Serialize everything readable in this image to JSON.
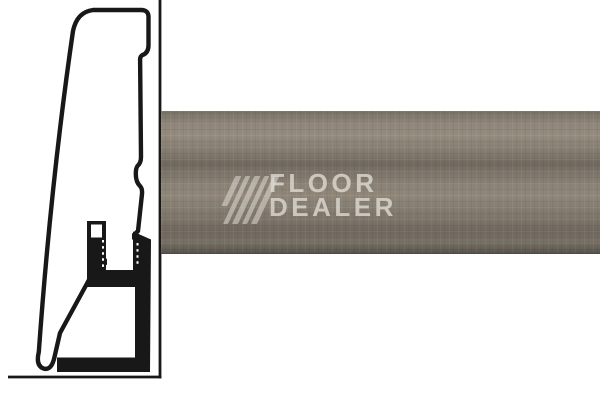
{
  "watermark": {
    "line1": "FLOOR",
    "line2": "DEALER"
  },
  "diagram": {
    "type": "skirting-board cross-section profile with mounting clip"
  },
  "colors": {
    "background": "#ffffff",
    "outline": "#181818",
    "wood_base": "#877e72",
    "wood_light": "#948b7e",
    "wood_dark": "#6e675d",
    "wood_edge": "#56524b",
    "watermark_color": "#dedbd4"
  }
}
